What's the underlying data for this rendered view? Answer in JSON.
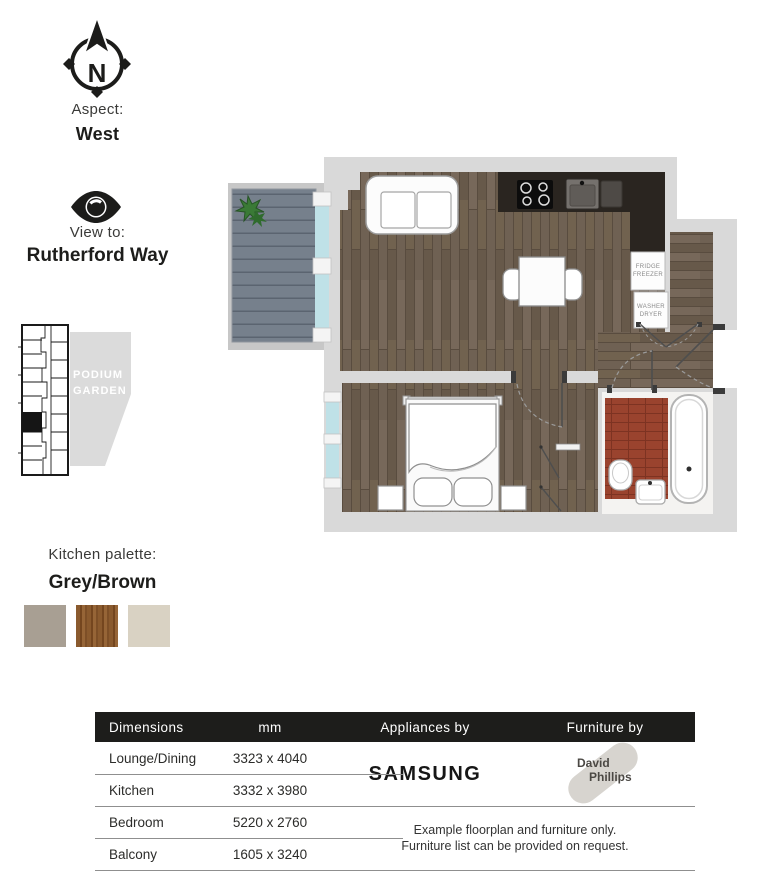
{
  "compass": {
    "letter": "N"
  },
  "aspect": {
    "label": "Aspect:",
    "value": "West"
  },
  "view": {
    "label": "View to:",
    "value": "Rutherford Way"
  },
  "keyplan": {
    "podium_line1": "PODIUM",
    "podium_line2": "GARDEN"
  },
  "palette": {
    "label": "Kitchen palette:",
    "value": "Grey/Brown",
    "swatches": [
      {
        "name": "grey",
        "color": "#a89f93"
      },
      {
        "name": "brown",
        "color": "#8a5a2e"
      },
      {
        "name": "cream",
        "color": "#d9d2c3"
      }
    ]
  },
  "floorplan": {
    "labels": {
      "fridge_line1": "FRIDGE",
      "fridge_line2": "FREEZER",
      "washer_line1": "WASHER",
      "washer_line2": "DRYER"
    },
    "colors": {
      "wood_floor": "#6f6153",
      "wall": "#d9d9d9",
      "kitchen_counter": "#2a2520",
      "balcony_deck": "#76808c",
      "bathroom_tile": "#9a432e",
      "glazing": "#bfe1e7",
      "plant": "#3a7a36"
    }
  },
  "table": {
    "header_bg": "#1d1d1b",
    "headers": [
      "Dimensions",
      "mm",
      "Appliances by",
      "Furniture by"
    ],
    "rows": [
      {
        "room": "Lounge/Dining",
        "size": "3323 x 4040"
      },
      {
        "room": "Kitchen",
        "size": "3332 x 3980"
      },
      {
        "room": "Bedroom",
        "size": "5220 x 2760"
      },
      {
        "room": "Balcony",
        "size": "1605 x 3240"
      }
    ],
    "appliances_brand": "SAMSUNG",
    "furniture_brand": {
      "line1": "David",
      "line2": "Phillips"
    },
    "note_line1": "Example floorplan and furniture only.",
    "note_line2": "Furniture list can be provided on request."
  }
}
